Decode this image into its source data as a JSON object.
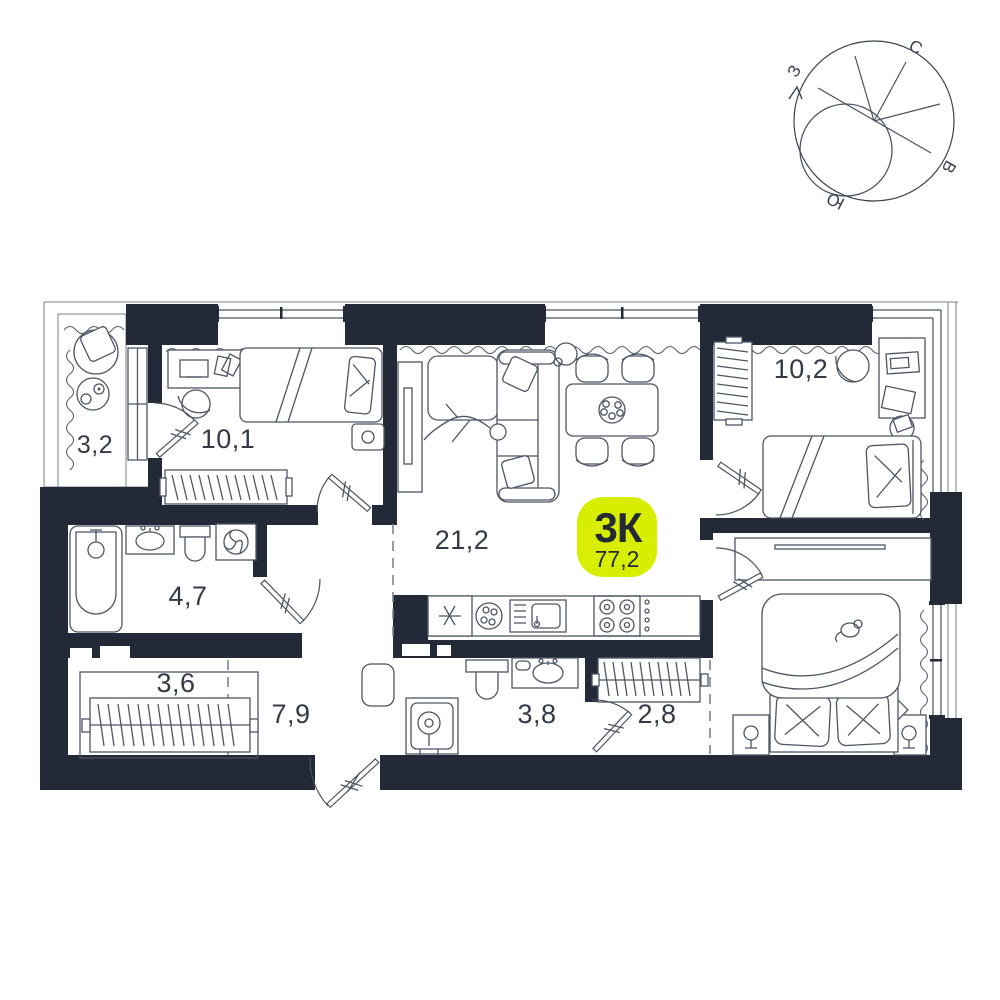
{
  "badge": {
    "type": "3К",
    "area": "77,2"
  },
  "compass": {
    "north": "С",
    "east": "В",
    "south": "Ю",
    "west": "З"
  },
  "rooms": [
    {
      "name": "balcony",
      "area": "3,2"
    },
    {
      "name": "bedroom-1",
      "area": "10,1"
    },
    {
      "name": "living-kitchen",
      "area": "21,2"
    },
    {
      "name": "bedroom-2",
      "area": "10,2"
    },
    {
      "name": "bathroom",
      "area": "4,7"
    },
    {
      "name": "wardrobe",
      "area": "3,6"
    },
    {
      "name": "hallway",
      "area": "7,9"
    },
    {
      "name": "shower-room",
      "area": "3,8"
    },
    {
      "name": "closet",
      "area": "2,8"
    }
  ],
  "colors": {
    "wall": "#232936",
    "accent": "#d8ee00",
    "glow": "#e3f600",
    "label_text": "#333a46",
    "badge_text": "#232a33"
  }
}
